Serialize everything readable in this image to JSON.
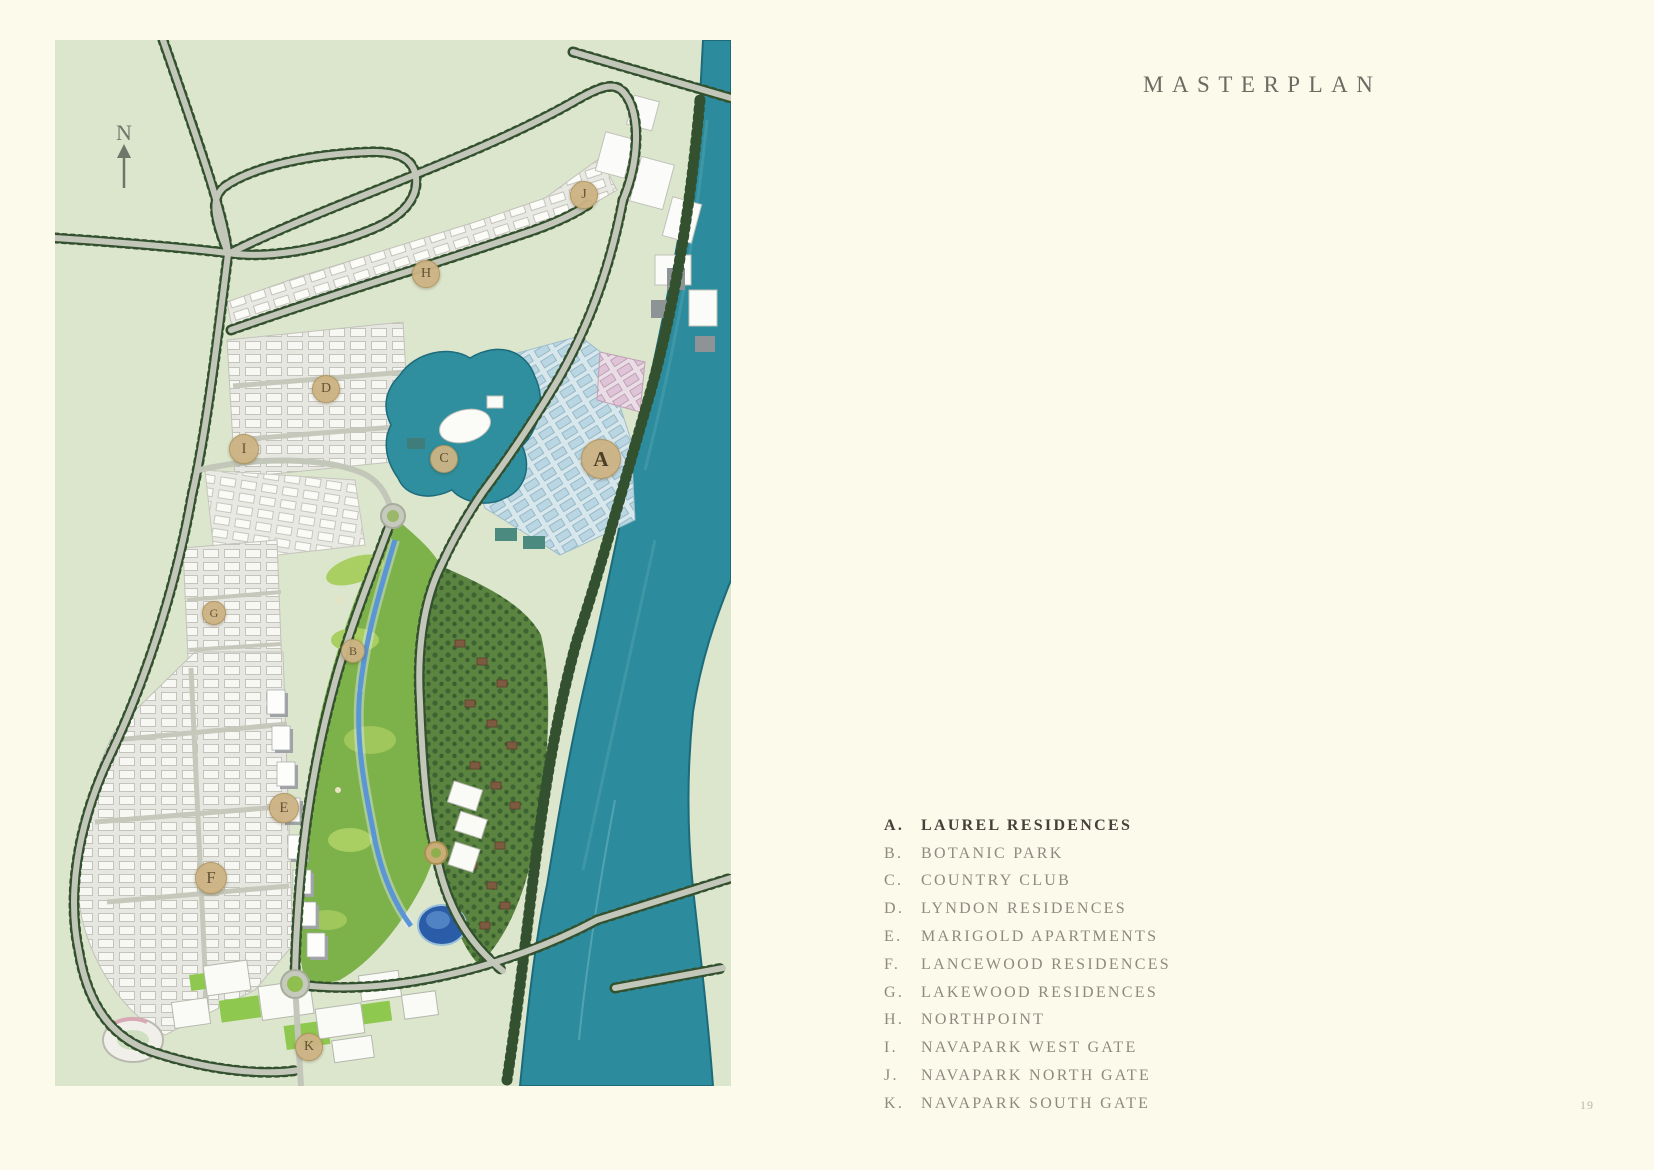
{
  "page": {
    "background_color": "#fcfaeb",
    "page_number": "19"
  },
  "header": {
    "title": "MASTERPLAN"
  },
  "map": {
    "north_indicator": "N",
    "colors": {
      "canvas_green": "#dce6cd",
      "river_teal": "#2c8b9c",
      "park_green": "#7db14a",
      "road_gray": "#c3c7b9",
      "tree_dark_green": "#33512e",
      "marker_gold": "#cdb384"
    },
    "markers": [
      {
        "letter": "A",
        "x": 545,
        "y": 418,
        "r": 19
      },
      {
        "letter": "B",
        "x": 297,
        "y": 610,
        "r": 11
      },
      {
        "letter": "C",
        "x": 388,
        "y": 418,
        "r": 13
      },
      {
        "letter": "D",
        "x": 270,
        "y": 348,
        "r": 13
      },
      {
        "letter": "E",
        "x": 228,
        "y": 767,
        "r": 14
      },
      {
        "letter": "F",
        "x": 155,
        "y": 837,
        "r": 15
      },
      {
        "letter": "G",
        "x": 158,
        "y": 572,
        "r": 11
      },
      {
        "letter": "H",
        "x": 370,
        "y": 233,
        "r": 13
      },
      {
        "letter": "I",
        "x": 188,
        "y": 408,
        "r": 14
      },
      {
        "letter": "J",
        "x": 528,
        "y": 154,
        "r": 13
      },
      {
        "letter": "K",
        "x": 253,
        "y": 1006,
        "r": 13
      }
    ]
  },
  "legend": {
    "items": [
      {
        "letter": "A.",
        "label": "LAUREL RESIDENCES"
      },
      {
        "letter": "B.",
        "label": "BOTANIC PARK"
      },
      {
        "letter": "C.",
        "label": "COUNTRY CLUB"
      },
      {
        "letter": "D.",
        "label": "LYNDON RESIDENCES"
      },
      {
        "letter": "E.",
        "label": "MARIGOLD APARTMENTS"
      },
      {
        "letter": "F.",
        "label": "LANCEWOOD RESIDENCES"
      },
      {
        "letter": "G.",
        "label": "LAKEWOOD RESIDENCES"
      },
      {
        "letter": "H.",
        "label": "NORTHPOINT"
      },
      {
        "letter": "I.",
        "label": "NAVAPARK WEST GATE"
      },
      {
        "letter": "J.",
        "label": "NAVAPARK NORTH GATE"
      },
      {
        "letter": "K.",
        "label": "NAVAPARK SOUTH GATE"
      }
    ]
  }
}
